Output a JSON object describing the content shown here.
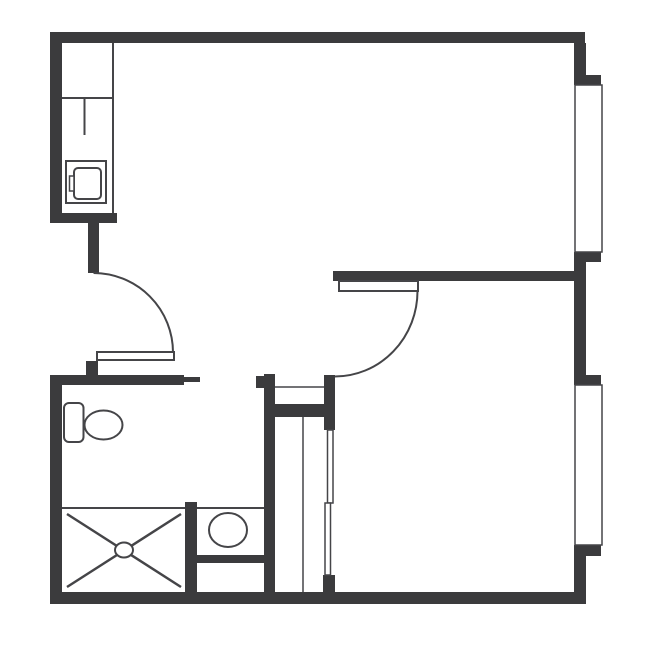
{
  "colors": {
    "wall": "#3b3b3d",
    "line": "#454548",
    "background": "#ffffff"
  },
  "canvas": {
    "width": 650,
    "height": 650
  },
  "plan": {
    "walls": [
      {
        "name": "top-wall",
        "x": 50,
        "y": 32,
        "w": 535,
        "h": 11
      },
      {
        "name": "left-wall-upper",
        "x": 50,
        "y": 43,
        "w": 12,
        "h": 180
      },
      {
        "name": "kitchen-end-wall",
        "x": 50,
        "y": 213,
        "w": 67,
        "h": 10
      },
      {
        "name": "entry-door-stub-wall",
        "x": 88,
        "y": 223,
        "w": 11,
        "h": 50
      },
      {
        "name": "entry-door-nub-wall",
        "x": 86,
        "y": 361,
        "w": 12,
        "h": 15
      },
      {
        "name": "bathroom-top-wall",
        "x": 50,
        "y": 375,
        "w": 134,
        "h": 10
      },
      {
        "name": "bathroom-door-jamb",
        "x": 184,
        "y": 377,
        "w": 16,
        "h": 5
      },
      {
        "name": "left-wall-lower",
        "x": 50,
        "y": 375,
        "w": 12,
        "h": 229
      },
      {
        "name": "bottom-wall",
        "x": 50,
        "y": 592,
        "w": 536,
        "h": 12
      },
      {
        "name": "shower-partition-wall",
        "x": 185,
        "y": 502,
        "w": 12,
        "h": 90
      },
      {
        "name": "vanity-front-wall",
        "x": 197,
        "y": 555,
        "w": 67,
        "h": 8
      },
      {
        "name": "closet-left-wall",
        "x": 264,
        "y": 374,
        "w": 11,
        "h": 218
      },
      {
        "name": "closet-left-nub",
        "x": 256,
        "y": 376,
        "w": 8,
        "h": 12
      },
      {
        "name": "closet-right-wall",
        "x": 324,
        "y": 375,
        "w": 11,
        "h": 55
      },
      {
        "name": "closet-middle-wall",
        "x": 264,
        "y": 404,
        "w": 71,
        "h": 13
      },
      {
        "name": "closet-bottom-stub",
        "x": 323,
        "y": 575,
        "w": 12,
        "h": 17
      },
      {
        "name": "bedroom-dividing-wall",
        "x": 333,
        "y": 271,
        "w": 253,
        "h": 10
      },
      {
        "name": "right-wall-upper",
        "x": 574,
        "y": 43,
        "w": 12,
        "h": 32
      },
      {
        "name": "window-1-top-cap",
        "x": 574,
        "y": 75,
        "w": 27,
        "h": 10
      },
      {
        "name": "window-1-bottom-cap",
        "x": 574,
        "y": 252,
        "w": 27,
        "h": 10
      },
      {
        "name": "right-wall-middle",
        "x": 574,
        "y": 262,
        "w": 12,
        "h": 113
      },
      {
        "name": "window-2-top-cap",
        "x": 574,
        "y": 375,
        "w": 27,
        "h": 10
      },
      {
        "name": "window-2-bottom-cap",
        "x": 574,
        "y": 545,
        "w": 27,
        "h": 11
      },
      {
        "name": "right-wall-lower",
        "x": 574,
        "y": 556,
        "w": 12,
        "h": 48
      }
    ],
    "lines": [
      {
        "name": "kitchen-counter-edge",
        "x1": 113,
        "y1": 43,
        "x2": 113,
        "y2": 213,
        "sw": 2
      },
      {
        "name": "kitchen-counter-divider",
        "x1": 62,
        "y1": 98,
        "x2": 113,
        "y2": 98,
        "sw": 2
      },
      {
        "name": "kitchen-sink-divider",
        "x1": 84.5,
        "y1": 98,
        "x2": 84.5,
        "y2": 135,
        "sw": 2
      },
      {
        "name": "window-1-inner-line-1",
        "x1": 584,
        "y1": 85,
        "x2": 584,
        "y2": 252,
        "sw": 1.5
      },
      {
        "name": "window-1-inner-line-2",
        "x1": 593.5,
        "y1": 85,
        "x2": 593.5,
        "y2": 252,
        "sw": 1.5
      },
      {
        "name": "window-1-sash-line-1",
        "x1": 584,
        "y1": 164.5,
        "x2": 602,
        "y2": 164.5,
        "sw": 1.5
      },
      {
        "name": "window-1-sash-line-2",
        "x1": 584,
        "y1": 168.5,
        "x2": 602,
        "y2": 168.5,
        "sw": 1.5
      },
      {
        "name": "window-2-inner-line-1",
        "x1": 584,
        "y1": 385,
        "x2": 584,
        "y2": 545,
        "sw": 1.5
      },
      {
        "name": "window-2-inner-line-2",
        "x1": 593.5,
        "y1": 385,
        "x2": 593.5,
        "y2": 545,
        "sw": 1.5
      },
      {
        "name": "window-2-sash-line-1",
        "x1": 584,
        "y1": 464,
        "x2": 602,
        "y2": 464,
        "sw": 1.5
      },
      {
        "name": "window-2-sash-line-2",
        "x1": 584,
        "y1": 468,
        "x2": 602,
        "y2": 468,
        "sw": 1.5
      },
      {
        "name": "closet-shelf-line",
        "x1": 275,
        "y1": 387,
        "x2": 324,
        "y2": 387,
        "sw": 1.5
      },
      {
        "name": "closet-divider-line",
        "x1": 303,
        "y1": 417,
        "x2": 303,
        "y2": 592,
        "sw": 1.5
      },
      {
        "name": "shower-edge-line",
        "x1": 62,
        "y1": 508,
        "x2": 185,
        "y2": 508,
        "sw": 2
      },
      {
        "name": "vanity-edge-line",
        "x1": 197,
        "y1": 508,
        "x2": 264,
        "y2": 508,
        "sw": 2
      },
      {
        "name": "shower-cross-line-1",
        "x1": 67,
        "y1": 514,
        "x2": 181,
        "y2": 587,
        "sw": 2.5
      },
      {
        "name": "shower-cross-line-2",
        "x1": 181,
        "y1": 514,
        "x2": 67,
        "y2": 587,
        "sw": 2.5
      }
    ],
    "arcs": [
      {
        "name": "entry-door-swing-arc",
        "d": "M 93.5 273 A 79.5 79.5 0 0 1 173 352.5",
        "sw": 2
      },
      {
        "name": "bedroom-door-swing-arc",
        "d": "M 417.5 291 A 82.7 85.5 0 0 1 334.8 376.5",
        "sw": 2
      }
    ],
    "outline_rects": [
      {
        "name": "window-1-frame",
        "x": 575,
        "y": 85,
        "w": 27,
        "h": 167,
        "sw": 1.5,
        "rx": 0
      },
      {
        "name": "window-2-frame",
        "x": 575,
        "y": 385,
        "w": 27,
        "h": 160,
        "sw": 1.5,
        "rx": 0
      },
      {
        "name": "kitchen-appliance-outer",
        "x": 66,
        "y": 161,
        "w": 40,
        "h": 42,
        "sw": 2,
        "rx": 0
      },
      {
        "name": "kitchen-appliance-door",
        "x": 74,
        "y": 168,
        "w": 27,
        "h": 31,
        "sw": 2,
        "rx": 4
      },
      {
        "name": "kitchen-appliance-handle",
        "x": 69.5,
        "y": 176,
        "w": 4.5,
        "h": 15,
        "sw": 1.5,
        "rx": 0
      },
      {
        "name": "toilet-tank",
        "x": 64,
        "y": 403,
        "w": 19.5,
        "h": 39,
        "sw": 2,
        "rx": 5
      },
      {
        "name": "entry-door-leaf",
        "x": 97,
        "y": 352,
        "w": 77,
        "h": 8,
        "sw": 2,
        "rx": 0
      },
      {
        "name": "bedroom-door-leaf",
        "x": 339,
        "y": 281,
        "w": 79,
        "h": 10,
        "sw": 2,
        "rx": 0
      },
      {
        "name": "closet-slider-panel-1",
        "x": 327.5,
        "y": 430,
        "w": 5.5,
        "h": 73,
        "sw": 1.5,
        "rx": 0
      },
      {
        "name": "closet-slider-panel-2",
        "x": 325,
        "y": 503,
        "w": 5.5,
        "h": 72,
        "sw": 1.5,
        "rx": 0
      }
    ],
    "ellipses": [
      {
        "name": "toilet-bowl",
        "cx": 103.5,
        "cy": 425,
        "rx": 19,
        "ry": 14.5,
        "sw": 2
      },
      {
        "name": "vanity-basin",
        "cx": 228,
        "cy": 530,
        "rx": 19,
        "ry": 17,
        "sw": 2
      },
      {
        "name": "shower-drain",
        "cx": 124,
        "cy": 550,
        "rx": 9,
        "ry": 7.5,
        "sw": 2
      }
    ]
  }
}
